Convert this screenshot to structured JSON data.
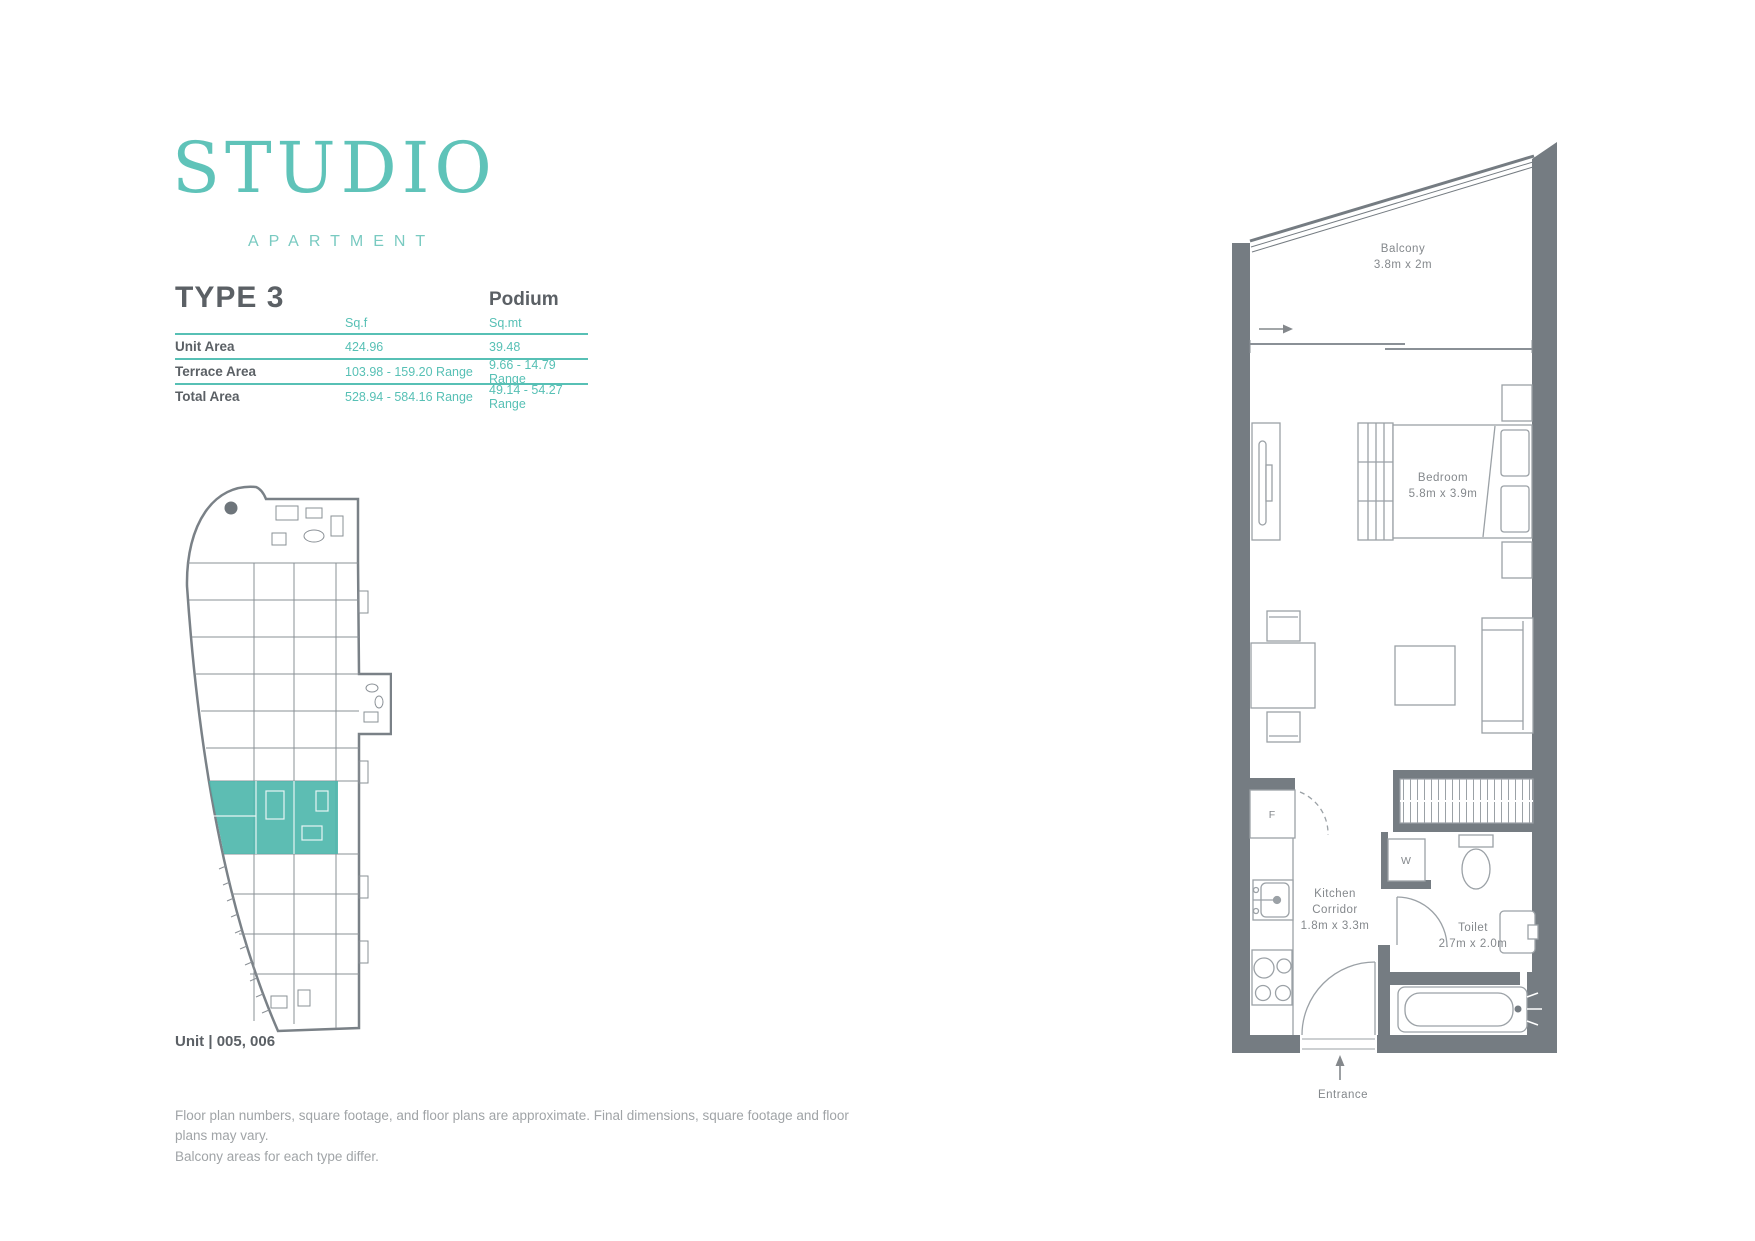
{
  "brand": {
    "title": "STUDIO",
    "subtitle": "APARTMENT"
  },
  "header": {
    "type_label": "TYPE 3",
    "location_label": "Podium"
  },
  "area_table": {
    "columns": [
      "Sq.f",
      "Sq.mt"
    ],
    "rows": [
      {
        "label": "Unit Area",
        "sqf": "424.96",
        "sqmt": "39.48"
      },
      {
        "label": "Terrace Area",
        "sqf": "103.98 - 159.20 Range",
        "sqmt": "9.66 - 14.79 Range"
      },
      {
        "label": "Total Area",
        "sqf": "528.94 - 584.16 Range",
        "sqmt": "49.14 - 54.27 Range"
      }
    ]
  },
  "unit_label": "Unit | 005, 006",
  "disclaimer": [
    "Floor plan numbers, square footage, and floor plans are approximate. Final dimensions, square footage and floor plans may vary.",
    "Balcony areas for each type differ."
  ],
  "floor_plan": {
    "rooms": {
      "balcony": {
        "name": "Balcony",
        "dims": "3.8m x 2m"
      },
      "bedroom": {
        "name": "Bedroom",
        "dims": "5.8m x 3.9m"
      },
      "kitchen": {
        "name_line1": "Kitchen",
        "name_line2": "Corridor",
        "dims": "1.8m x 3.3m"
      },
      "toilet": {
        "name": "Toilet",
        "dims": "2.7m x 2.0m"
      }
    },
    "entrance_label": "Entrance",
    "fridge_label": "F",
    "washer_label": "W"
  },
  "colors": {
    "accent": "#57c0b5",
    "title_teal": "#5fc3b9",
    "highlight": "#4fb7ad",
    "wall_gray": "#757c82",
    "line_gray": "#9ba1a6",
    "text_dark": "#5b6065",
    "text_gray": "#a0a4a7"
  }
}
